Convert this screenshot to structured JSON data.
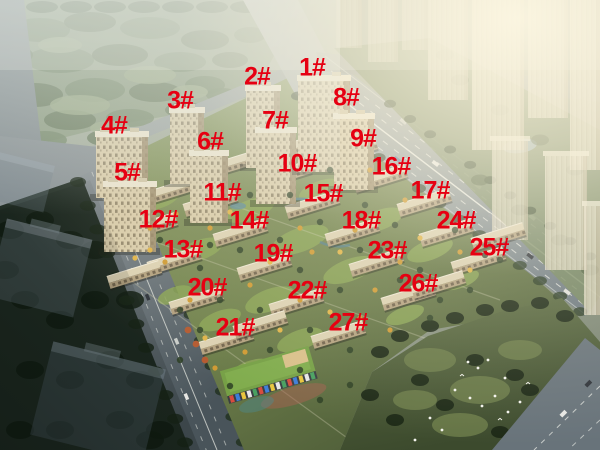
{
  "scene": {
    "description_label": "",
    "label_color": "#e60012"
  },
  "buildings": [
    {
      "label": "1#",
      "x": 312,
      "y": 69
    },
    {
      "label": "2#",
      "x": 257,
      "y": 78
    },
    {
      "label": "3#",
      "x": 180,
      "y": 102
    },
    {
      "label": "4#",
      "x": 114,
      "y": 127
    },
    {
      "label": "5#",
      "x": 127,
      "y": 174
    },
    {
      "label": "6#",
      "x": 210,
      "y": 143
    },
    {
      "label": "7#",
      "x": 275,
      "y": 122
    },
    {
      "label": "8#",
      "x": 346,
      "y": 99
    },
    {
      "label": "9#",
      "x": 363,
      "y": 140
    },
    {
      "label": "10#",
      "x": 297,
      "y": 165
    },
    {
      "label": "11#",
      "x": 222,
      "y": 194
    },
    {
      "label": "12#",
      "x": 158,
      "y": 221
    },
    {
      "label": "13#",
      "x": 183,
      "y": 251
    },
    {
      "label": "14#",
      "x": 249,
      "y": 222
    },
    {
      "label": "15#",
      "x": 323,
      "y": 195
    },
    {
      "label": "16#",
      "x": 391,
      "y": 168
    },
    {
      "label": "17#",
      "x": 430,
      "y": 192
    },
    {
      "label": "18#",
      "x": 361,
      "y": 222
    },
    {
      "label": "19#",
      "x": 273,
      "y": 255
    },
    {
      "label": "20#",
      "x": 207,
      "y": 289
    },
    {
      "label": "21#",
      "x": 235,
      "y": 329
    },
    {
      "label": "22#",
      "x": 307,
      "y": 292
    },
    {
      "label": "23#",
      "x": 387,
      "y": 252
    },
    {
      "label": "24#",
      "x": 456,
      "y": 222
    },
    {
      "label": "25#",
      "x": 489,
      "y": 249
    },
    {
      "label": "26#",
      "x": 418,
      "y": 285
    },
    {
      "label": "27#",
      "x": 348,
      "y": 324
    }
  ]
}
